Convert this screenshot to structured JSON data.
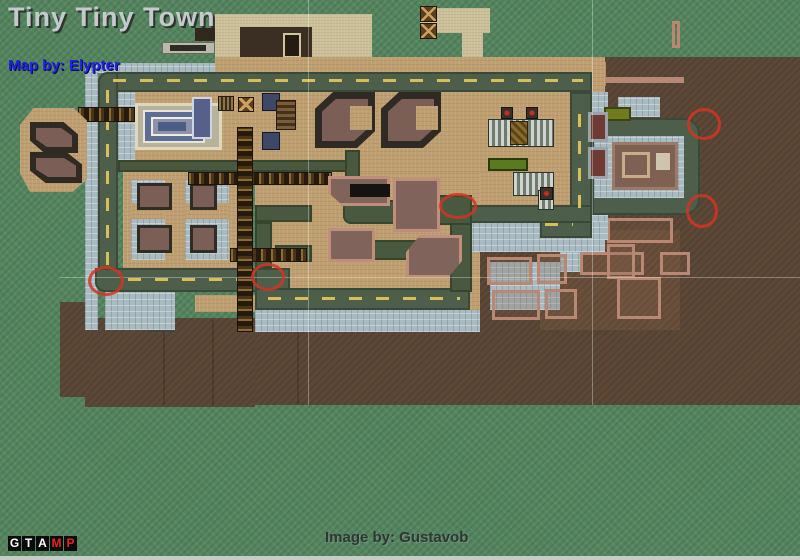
{
  "header": {
    "title": "Tiny Tiny Town",
    "map_credit": "Map by: Elypter"
  },
  "footer": {
    "image_credit": "Image by: Gustavob"
  },
  "logo": {
    "tile_bg": "#0a0a0a",
    "letters": [
      {
        "ch": "G",
        "color": "#ffffff"
      },
      {
        "ch": "T",
        "color": "#ffffff"
      },
      {
        "ch": "A",
        "color": "#ffffff"
      },
      {
        "ch": "M",
        "color": "#e8251c"
      },
      {
        "ch": "P",
        "color": "#e8251c"
      }
    ]
  },
  "map": {
    "colors": {
      "grass": "#55855f",
      "dirt": "#5c4837",
      "plaza_tan": "#bf9f70",
      "sidewalk": "#a9bbc1",
      "road": "#4d5f4a",
      "road_dash": "#d9be58",
      "pier_gold": "#8d6c33",
      "building_mauve": "#7b5f57",
      "building_outline_salmon": "#b98873",
      "marker_red": "#d63422"
    },
    "markers": [
      {
        "x": 106,
        "y": 281,
        "rx": 18,
        "ry": 15
      },
      {
        "x": 268,
        "y": 277,
        "rx": 17,
        "ry": 14
      },
      {
        "x": 458,
        "y": 206,
        "rx": 19,
        "ry": 13
      },
      {
        "x": 704,
        "y": 124,
        "rx": 17,
        "ry": 16
      },
      {
        "x": 702,
        "y": 211,
        "rx": 16,
        "ry": 17
      }
    ],
    "gridlines": {
      "vertical_x": [
        308,
        592
      ],
      "horizontal_y": [
        277
      ],
      "vertical_extent": [
        0,
        405
      ],
      "horizontal_extent": [
        60,
        800
      ]
    }
  }
}
